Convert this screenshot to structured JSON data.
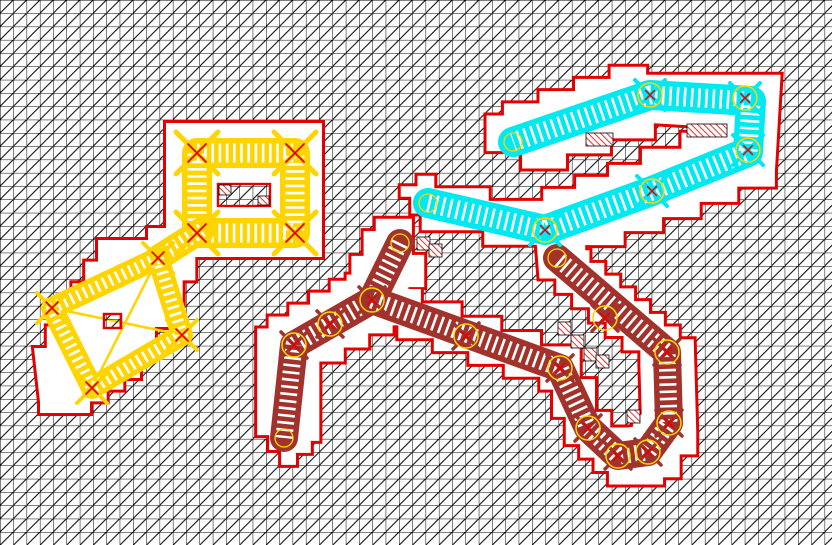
{
  "canvas": {
    "width": 832,
    "height": 545,
    "cell": 13.3
  },
  "colors": {
    "background": "#ffffff",
    "grid_line": "#000000",
    "boundary_red": "#e30000",
    "hatch_red": "#e30000",
    "yellow": "#ffd400",
    "cyan": "#00e8f0",
    "maroon": "#a2332c",
    "joint_circle": "#ffd400",
    "white": "#ffffff"
  },
  "regions": {
    "yellow_outline": [
      [
        166,
        123
      ],
      [
        322,
        123
      ],
      [
        322,
        257
      ],
      [
        208,
        257
      ],
      [
        170,
        327
      ],
      [
        140,
        378
      ],
      [
        90,
        413
      ],
      [
        40,
        402
      ],
      [
        34,
        348
      ],
      [
        98,
        240
      ],
      [
        148,
        228
      ],
      [
        166,
        228
      ]
    ],
    "cyan": {
      "centerline": [
        [
          428,
          203
        ],
        [
          545,
          230
        ],
        [
          652,
          191
        ],
        [
          748,
          152
        ],
        [
          751,
          101
        ],
        [
          650,
          95
        ],
        [
          513,
          142
        ]
      ],
      "offset": 28
    },
    "maroon_branches": [
      {
        "centerline": [
          [
            400,
            243
          ],
          [
            372,
            300
          ],
          [
            294,
            345
          ],
          [
            284,
            438
          ]
        ],
        "offset": 27
      },
      {
        "centerline": [
          [
            372,
            300
          ],
          [
            560,
            368
          ],
          [
            588,
            428
          ],
          [
            618,
            456
          ],
          [
            648,
            452
          ],
          [
            669,
            423
          ],
          [
            667,
            352
          ],
          [
            557,
            258
          ]
        ],
        "offset": 27
      }
    ]
  },
  "bands": {
    "dash": "2.6 4.6",
    "frame": {
      "rect": [
        197,
        153,
        295,
        233
      ],
      "width": 30,
      "overlay": 19
    },
    "diamond": {
      "points": [
        [
          158,
          258
        ],
        [
          182,
          335
        ],
        [
          92,
          388
        ],
        [
          52,
          308
        ]
      ],
      "width": 22,
      "overlay": 12
    },
    "connector": {
      "points": [
        [
          202,
          230
        ],
        [
          158,
          258
        ]
      ],
      "width": 26,
      "overlay": 15
    },
    "cyan": {
      "width": 30,
      "overlay": 19
    },
    "maroon": {
      "width": 28,
      "overlay": 17
    }
  },
  "braces": {
    "diamond": [
      [
        [
          158,
          258
        ],
        [
          92,
          388
        ]
      ],
      [
        [
          52,
          308
        ],
        [
          182,
          335
        ]
      ]
    ]
  },
  "islands": {
    "frame_inner_rect": {
      "x": 218,
      "y": 184,
      "w": 52,
      "h": 22
    },
    "diamond_square": {
      "x": 104,
      "y": 314,
      "w": 17,
      "h": 14
    }
  },
  "hatch_cells": [
    [
      687,
      124,
      40,
      13
    ],
    [
      586,
      133,
      27,
      13
    ],
    [
      417,
      237,
      13,
      13
    ],
    [
      429,
      244,
      13,
      13
    ],
    [
      558,
      322,
      13,
      13
    ],
    [
      571,
      335,
      13,
      13
    ],
    [
      584,
      348,
      13,
      13
    ],
    [
      596,
      355,
      13,
      13
    ],
    [
      627,
      410,
      13,
      13
    ],
    [
      219,
      185,
      12,
      10
    ],
    [
      258,
      196,
      11,
      9
    ]
  ],
  "joints": {
    "frame_corners": [
      [
        197,
        153
      ],
      [
        295,
        153
      ],
      [
        295,
        233
      ],
      [
        197,
        233
      ]
    ],
    "diamond_vertices": [
      [
        158,
        258
      ],
      [
        182,
        335
      ],
      [
        92,
        388
      ],
      [
        52,
        308
      ]
    ],
    "cyan": [
      [
        545,
        230
      ],
      [
        652,
        191
      ],
      [
        748,
        150
      ],
      [
        745,
        98
      ],
      [
        650,
        95
      ]
    ],
    "maroon": [
      [
        372,
        300
      ],
      [
        330,
        324
      ],
      [
        294,
        345
      ],
      [
        466,
        336
      ],
      [
        560,
        368
      ],
      [
        588,
        428
      ],
      [
        618,
        456
      ],
      [
        648,
        452
      ],
      [
        669,
        423
      ],
      [
        667,
        352
      ],
      [
        605,
        318
      ]
    ],
    "maroon_caps": [
      [
        400,
        243
      ],
      [
        284,
        438
      ],
      [
        557,
        258
      ]
    ],
    "cyan_caps": [
      [
        428,
        203
      ],
      [
        513,
        142
      ]
    ]
  }
}
